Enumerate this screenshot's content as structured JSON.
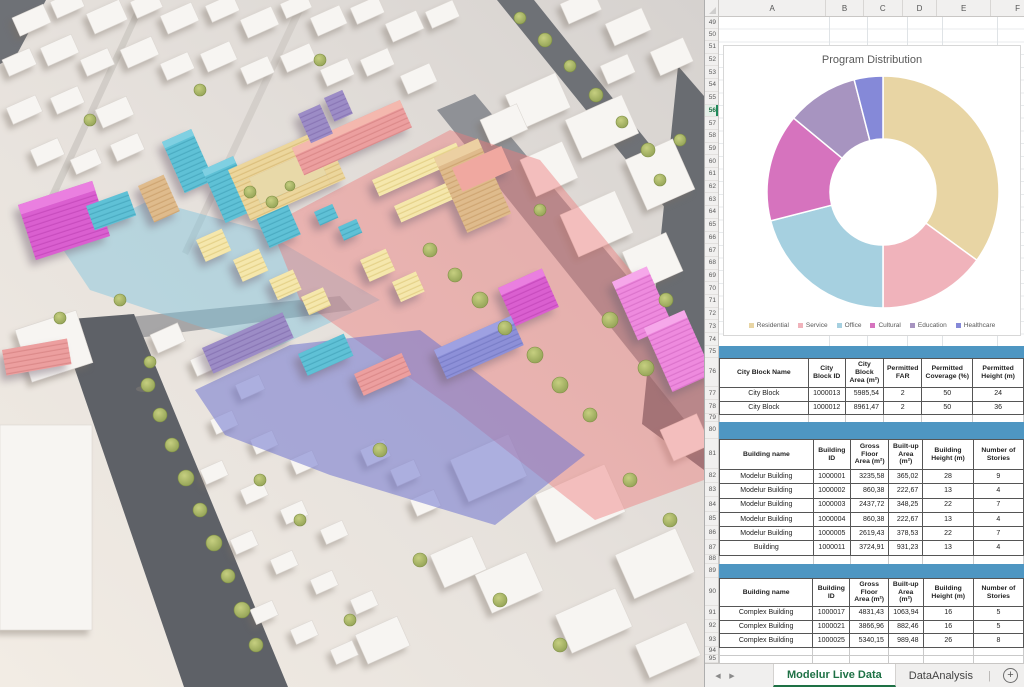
{
  "viewport3d": {
    "label": "3D urban massing model",
    "zone_colors": {
      "residential_yellow": "#ecd69c",
      "office_cyan": "#5fc1d6",
      "cultural_magenta": "#da5fd0",
      "education_purple": "#9c8cc6",
      "healthcare_blue": "#8d90d8",
      "service_salmon": "#ec9f9f",
      "overlay_red": "#ee7d7d",
      "overlay_purple": "#6f74cf",
      "overlay_blue": "#7cc3de",
      "road": "#63666c",
      "tree": "#9cab58",
      "massing_white": "#f7f5f2"
    }
  },
  "spreadsheet": {
    "column_headers": [
      "A",
      "B",
      "C",
      "D",
      "E",
      "F"
    ],
    "row_numbers": [
      49,
      50,
      51,
      52,
      53,
      54,
      55,
      56,
      57,
      58,
      59,
      60,
      61,
      62,
      63,
      64,
      65,
      66,
      67,
      68,
      69,
      70,
      71,
      72,
      73,
      74,
      75,
      76,
      77,
      78,
      79,
      80,
      81,
      82,
      83,
      84,
      85,
      86,
      87,
      88,
      89,
      90,
      91,
      92,
      93,
      94,
      95
    ],
    "active_row": 56,
    "header_band_color": "#4e96c2",
    "tables": [
      {
        "name": "city-blocks",
        "headers": [
          "City Block Name",
          "City Block ID",
          "City Block Area (m²)",
          "Permitted FAR",
          "Permitted Coverage (%)",
          "Permitted Height (m)"
        ],
        "rows": [
          [
            "City Block",
            "1000013",
            "5985,54",
            "2",
            "50",
            "24"
          ],
          [
            "City Block",
            "1000012",
            "8961,47",
            "2",
            "50",
            "36"
          ]
        ]
      },
      {
        "name": "modelur-buildings",
        "headers": [
          "Building name",
          "Building ID",
          "Gross Floor Area (m²)",
          "Built-up Area (m²)",
          "Building Height (m)",
          "Number of Stories"
        ],
        "rows": [
          [
            "Modelur Building",
            "1000001",
            "3235,58",
            "365,02",
            "28",
            "9"
          ],
          [
            "Modelur Building",
            "1000002",
            "860,38",
            "222,67",
            "13",
            "4"
          ],
          [
            "Modelur Building",
            "1000003",
            "2437,72",
            "348,25",
            "22",
            "7"
          ],
          [
            "Modelur Building",
            "1000004",
            "860,38",
            "222,67",
            "13",
            "4"
          ],
          [
            "Modelur Building",
            "1000005",
            "2619,43",
            "378,53",
            "22",
            "7"
          ],
          [
            "Building",
            "1000011",
            "3724,91",
            "931,23",
            "13",
            "4"
          ]
        ]
      },
      {
        "name": "complex-buildings",
        "headers": [
          "Building name",
          "Building ID",
          "Gross Floor Area (m²)",
          "Built-up Area (m²)",
          "Building Height (m)",
          "Number of Stories"
        ],
        "rows": [
          [
            "Complex Building",
            "1000017",
            "4831,43",
            "1063,94",
            "16",
            "5"
          ],
          [
            "Complex Building",
            "1000021",
            "3866,96",
            "882,46",
            "16",
            "5"
          ],
          [
            "Complex Building",
            "1000025",
            "5340,15",
            "989,48",
            "26",
            "8"
          ]
        ]
      }
    ],
    "sheet_tabs": {
      "active": "Modelur Live Data",
      "inactive": "DataAnalysis",
      "add_label": "+"
    }
  },
  "chart_data": {
    "type": "pie",
    "subtype": "donut",
    "title": "Program Distribution",
    "categories": [
      "Residential",
      "Service",
      "Office",
      "Cultural",
      "Education",
      "Healthcare"
    ],
    "values": [
      35,
      15,
      21,
      15,
      10,
      4
    ],
    "colors": [
      "#e8d5a4",
      "#f0b3bb",
      "#a6d0e0",
      "#d673be",
      "#a794c0",
      "#8589d8"
    ],
    "donut_hole_ratio": 0.46,
    "legend_position": "bottom",
    "title_color": "#595959"
  }
}
